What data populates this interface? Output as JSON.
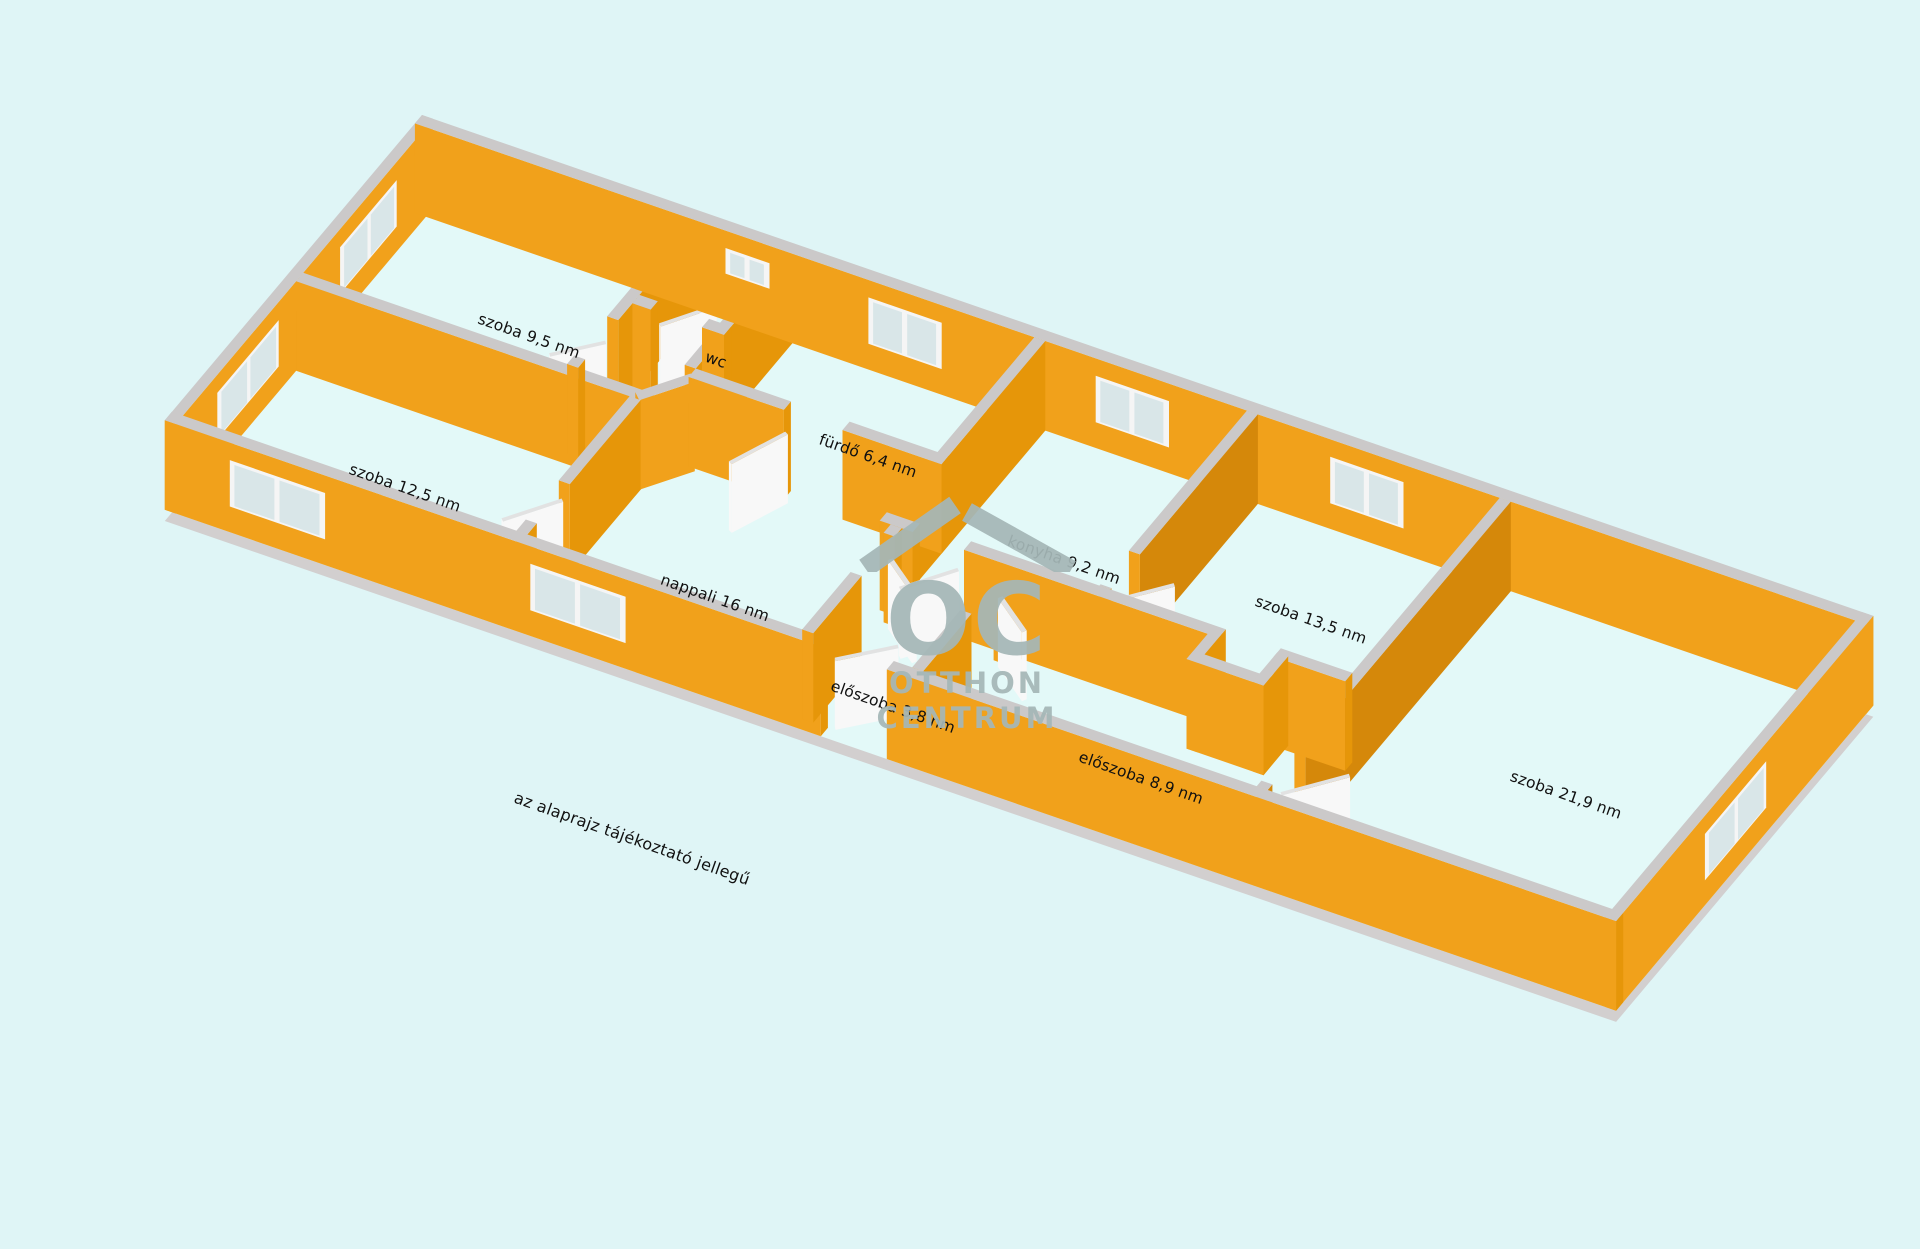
{
  "page": {
    "background_color": "#DFF5F6",
    "type_note": "3D floor plan render"
  },
  "colors": {
    "wall_bright": "#F1A11B",
    "wall_medium": "#E69609",
    "wall_dark": "#D5880A",
    "wall_back_shade": "#E6960E",
    "wall_top": "#CBC9C9",
    "floor": "#E3F9F8",
    "slab": "#D2CFCF",
    "window_frame": "#F5F5F5",
    "window_pane": "#D9E6E8",
    "door_leaf": "#F8F8F8",
    "door_leaf_top": "#E2E2E2",
    "label_text": "#111111",
    "watermark_gray": "#A5B7B7"
  },
  "rooms": [
    {
      "name": "szoba",
      "area_nm": "9,5",
      "label": "szoba 9,5 nm"
    },
    {
      "name": "szoba",
      "area_nm": "12,5",
      "label": "szoba 12,5 nm"
    },
    {
      "name": "nappali",
      "area_nm": "16",
      "label": "nappali 16 nm"
    },
    {
      "name": "wc",
      "area_nm": "",
      "label": "wc"
    },
    {
      "name": "fürdő",
      "area_nm": "6,4",
      "label": "fürdő 6,4 nm"
    },
    {
      "name": "konyha",
      "area_nm": "9,2",
      "label": "konyha 9,2 nm"
    },
    {
      "name": "szoba",
      "area_nm": "13,5",
      "label": "szoba 13,5 nm"
    },
    {
      "name": "előszoba",
      "area_nm": "3,8",
      "label": "előszoba 3,8 nm"
    },
    {
      "name": "előszoba",
      "area_nm": "8,9",
      "label": "előszoba 8,9 nm"
    },
    {
      "name": "szoba",
      "area_nm": "21,9",
      "label": "szoba 21,9 nm"
    }
  ],
  "watermark": {
    "initials": "OC",
    "word1": "OTTHON",
    "word2": "CENTRUM"
  },
  "disclaimer": {
    "text": "az alaprajz tájékoztató jellegű"
  }
}
